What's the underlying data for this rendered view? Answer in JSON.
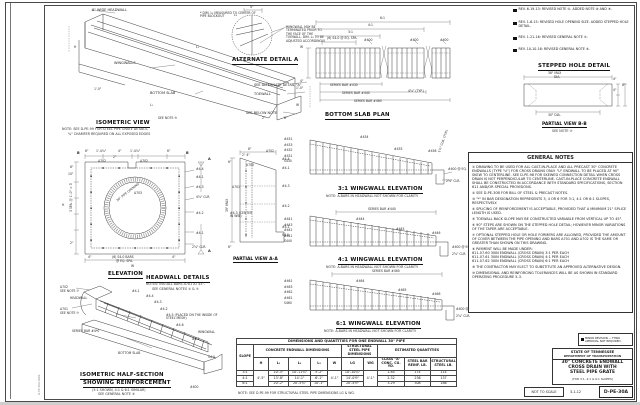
{
  "sheet": {
    "stamp": "D-PE-30A.DGN"
  },
  "iso": {
    "title": "ISOMETRIC VIEW",
    "note1": "NOTE: SEE D-PE-99 FOR STEEL PIPE GRATE DETAILS.",
    "note2": "¾\" CHAMFER REQUIRED ON ALL EXPOSED EDGES",
    "headwall": "8\" WIDE HEADWALL",
    "dim_note": "* DIM. L₂ MEASURED TO CENTER OF PIPE BLOCKOUT",
    "wingwalls": "WINGWALLS",
    "bottom_slab": "BOTTOM SLAB",
    "alt": "SEE ALTERNATE DETAIL \"A\"",
    "toewall": "TOEWALL",
    "below": "SEE BELOW NOTE",
    "note5": "SEE NOTE ⑤",
    "H": "H",
    "L1": "L₁",
    "L2": "L₂",
    "W": "W",
    "d10": "1'-0\"",
    "d8": "8\"",
    "d2": "2\""
  },
  "alt": {
    "title": "ALTERNATE DETAIL A",
    "note": "WINGWALL MAY BE TERMINATED PRIOR TO THE FACE OF THE TOEWALL. DIM. L₃ TO BE ADJUSTED ACCORDINGLY.",
    "d4": "4\"",
    "L3": "L₃"
  },
  "slab": {
    "title": "BOTTOM SLAB PLAN",
    "d61": "6:1",
    "d41": "4:1",
    "d31": "3:1",
    "spa": "(6) S4-0 @ EQ. SPA.",
    "b1": "#400",
    "b2": "#400",
    "b3": "#400",
    "s430": "SERIES BAR #430",
    "s440": "SERIES BAR #440",
    "s460": "SERIES BAR #460",
    "typ": "4⅝\" (TYP.)",
    "W": "W",
    "d4": "4\"",
    "d10": "1'-0\""
  },
  "elev": {
    "title": "ELEVATION",
    "B1": "B",
    "B2": "B",
    "A1": "A",
    "A2": "A",
    "t1": "6\"",
    "t2": "1'-4⅞\"",
    "t3": "4\"",
    "t4": "1'-4⅞\"",
    "t5": "6\"",
    "d2": "2\"",
    "a702": "A702",
    "a702b": "A702",
    "a703": "A703",
    "r1": "#4-4",
    "r2": "#4-1",
    "r3": "#4-3",
    "r4": "4⅝\" CLR.",
    "r5": "#4-2",
    "r6": "#4-1",
    "lspa": "3 SPA. @ 1'-0\" = 3'",
    "l8": "8\"",
    "l10": "10\"",
    "l2": "2\"",
    "H": "H",
    "pipe": "30\" PIPE OPENING",
    "bars": "(6) S4-0 BARS",
    "spa": "@ EQ. SPA.",
    "d4a": "4\"",
    "d4b": "4\"",
    "W": "W",
    "clr": "2⅝\" CLR."
  },
  "head": {
    "title": "HEADWALL DETAILS",
    "n1": "NOTES: INSTALL BARS A701 AT 45°.",
    "n2": "SEE GENERAL NOTES ⑤ & ⑦"
  },
  "pa": {
    "title": "PARTIAL VIEW A-A",
    "d8": "8\"",
    "d24": "2\" 4\"",
    "d6": "6\"",
    "d6b": "6\"",
    "max": "39\" MAX",
    "a702": "A702",
    "a700": "A700",
    "a701": "A701",
    "r1": "#4-4",
    "r2": "#4-1",
    "r3": "#4-3",
    "r4": "#4-2",
    "r5": "#4-1",
    "r6": "S4-0",
    "center": "#4-3 (CENTER IN WW)"
  },
  "ww3": {
    "title": "3:1 WINGWALL ELEVATION",
    "note": "NOTE: A-BARS IN HEADWALL NOT SHOWN FOR CLARITY.",
    "s1": "#431",
    "s2": "#433",
    "s3": "#432",
    "s4": "#431",
    "s5": "S430",
    "b4": "#434",
    "b5": "#435",
    "b6": "#436",
    "spa": "#400 @ EQ. SPA.",
    "clr": "2⅝\" CLR.",
    "diag": "1½\" CLR. (TYP.)"
  },
  "ww4": {
    "title": "4:1 WINGWALL ELEVATION",
    "note": "NOTE: A-BARS IN HEADWALL NOT SHOWN FOR CLARITY.",
    "series": "SERIES BAR #440",
    "s1": "#441",
    "s2": "#443",
    "s3": "#442",
    "s4": "#441",
    "s5": "S440",
    "b4": "#444",
    "b5": "#445",
    "b6": "#446",
    "spa": "#400 @ EQ. SPA.",
    "clr": "2⅝\" CLR."
  },
  "ww6": {
    "title": "6:1 WINGWALL ELEVATION",
    "note": "NOTE: A-BARS IN HEADWALL NOT SHOWN FOR CLARITY.",
    "series": "SERIES BAR #460",
    "s1": "#461",
    "s2": "#463",
    "s3": "#462",
    "s4": "#461",
    "s5": "S460",
    "b4": "#464",
    "b5": "#465",
    "b6": "#466",
    "spa": "#400 @ EQ. SPA.",
    "clr": "2⅝\" CLR."
  },
  "half": {
    "t1": "ISOMETRIC HALF-SECTION",
    "t2": "SHOWING REINFORCEMENT",
    "s1": "(3:1 SHOWN, 4:1 & 6:1 SIMILAR)",
    "s2": "SEE GENERAL NOTE ③",
    "a702": "A702",
    "see7a": "SEE NOTE ⑦",
    "a701": "A701",
    "see7b": "SEE NOTE ⑦",
    "headwall": "HEADWALL",
    "series": "SERIES BAR #4*0",
    "bottom": "BOTTOM SLAB",
    "wingwall": "WINGWALL",
    "b1": "#4-1",
    "b2": "#4-2",
    "b3": "#4-3",
    "b4": "#4-4",
    "b5": "#4-5 (PLACED ON THE INSIDE OF STEEL MESH)",
    "b6": "#4-6",
    "b1b": "#4-1",
    "s40": "S4-0",
    "b400": "#400"
  },
  "step": {
    "title": "STEPPED HOLE DETAIL",
    "max": "36\" MAX",
    "dia": "DIA.",
    "d30": "30\" DIA.",
    "d4a": "4\"",
    "d4b": "4\"",
    "d8": "8\"",
    "pb": "PARTIAL VIEW B-B",
    "note": "SEE NOTE ⑦"
  },
  "revisions": [
    "REV. 6-19-13: REVISED NOTE ⑤. ADDED NOTE ⑧ AND ⑨.",
    "REV. 1-6-15: REVISED HOLE OPENING SIZE. ADDED STEPPED HOLE DETAIL.",
    "REV. 1-21-16: REVISED GENERAL NOTE ⑤.",
    "REV. 10-10-16: REVISED GENERAL NOTE ⑥."
  ],
  "gn": {
    "title": "GENERAL NOTES",
    "items": [
      "① DRAWING TO BE USED FOR ALL CAST-IN-PLACE AND ALL PRECAST 30\" CONCRETE ENDWALLS (TYPE \"U\") FOR CROSS DRAINS ONLY. \"U\" ENDWALL TO BE PLACED AT 90° SKEW TO CENTERLINE. SEE D-PE-98 FOR SKEWED CONNECTION DETAIL WHEN CROSS DRAIN IS NOT PERPENDICULAR TO CENTERLINE. CAST-IN-PLACE CONCRETE ENDWALL SHALL BE CONSTRUCTED IN ACCORDANCE WITH STANDARD SPECIFICATIONS, SECTION 611 AND/OR SPECIAL PROVISIONS.",
      "② SEE D-PE-30B FOR BILL OF STEEL & PRECAST NOTES.",
      "③ \"*\" IN BAR DESIGNATION REPRESENTS 3, 4 OR 6 FOR 3:1, 4:1 OR 6:1 SLOPES, RESPECTIVELY.",
      "④ SPLICING OF REINFORCEMENT IS ACCEPTABLE, PROVIDED THAT A MINIMUM 21\" SPLICE LENGTH IS USED.",
      "⑤ TOEWALL BACK SLOPE MAY BE CONSTRUCTED VARIABLE FROM VERTICAL UP TO 45°.",
      "⑥ 90° STEPS ARE SHOWN ON THE STEPPED HOLE DETAIL; HOWEVER MINOR VARIATIONS OF THE TAPER ARE ACCEPTABLE.",
      "⑦ OPTIONAL STEPPED HOLE OR HOLE FORMERS ARE ALLOWED, PROVIDED THE AMOUNT OF COVER BETWEEN THE PIPE OPENING AND BARS A701 AND A702 IS THE SAME OR GREATER THAN SHOWN ON THIS DRAWING.",
      "⑧ PAYMENT WILL BE MADE UNDER:\n611-07.60  30IN ENDWALL (CROSS DRAIN) 3:1  PER EACH\n611-07.61  30IN ENDWALL (CROSS DRAIN) 4:1  PER EACH\n611-07.62  30IN ENDWALL (CROSS DRAIN) 6:1  PER EACH",
      "⑨ THE CONTRACTOR MAY ELECT TO SUBSTITUTE AN APPROVED ALTERNATIVE DESIGN.",
      "⑩ DIMENSIONAL AND REINFORCING TOLERANCES WILL BE AS SHOWN IN STANDARD OPERATING PROCEDURE 5-3."
    ]
  },
  "minor": "MINOR REVISION — FHWA APPROVAL NOT REQUIRED.",
  "tb": {
    "agency1": "STATE OF TENNESSEE",
    "agency2": "DEPARTMENT OF TRANSPORTATION",
    "l1": "30\" CONCRETE ENDWALL",
    "l2": "CROSS DRAIN WITH",
    "l3": "STEEL PIPE GRATE",
    "sub": "(FOR 3:1, 4:1 & 6:1 SLOPES)",
    "scale": "NOT TO SCALE",
    "date": "3-1-12",
    "num": "D-PE-30A"
  },
  "table": {
    "title": "DIMENSIONS AND QUANTITIES FOR ONE ENDWALL 30\" PIPE",
    "g_slope": "SLOPE",
    "g_conc": "CONCRETE ENDWALL DIMENSIONS",
    "g_steel": "STRUCTURAL STEEL PIPE\nDIMENSIONS",
    "g_est": "ESTIMATED QUANTITIES",
    "h": [
      "H",
      "L₁",
      "L₂",
      "L₃",
      "W",
      "LG",
      "WG",
      "CLASS \"A\"\nCONC. CU. YD.",
      "STEEL BAR\nREINF. LB.",
      "STRUCTURAL\nSTEEL LB."
    ],
    "r0": [
      "3:1",
      "4'-5\"",
      "10'-5\"",
      "10'-11¾\"",
      "5'-2\"",
      "4'-1\"",
      "10'-10¾\"",
      "4'-1\"",
      "1.84",
      "174",
      "114"
    ],
    "r1": [
      "4:1",
      "13'-8\"",
      "14'-1\"",
      "6'-1\"",
      "14'-0½\"",
      "2.32",
      "236",
      "137"
    ],
    "r2": [
      "6:1",
      "20'-2\"",
      "20'-5¾\"",
      "10'-1\"",
      "20'-4½\"",
      "3.29",
      "308",
      "186"
    ],
    "note": "NOTE: SEE D-PE-99 FOR STRUCTURAL STEEL PIPE DIMENSIONS LG & WG."
  }
}
